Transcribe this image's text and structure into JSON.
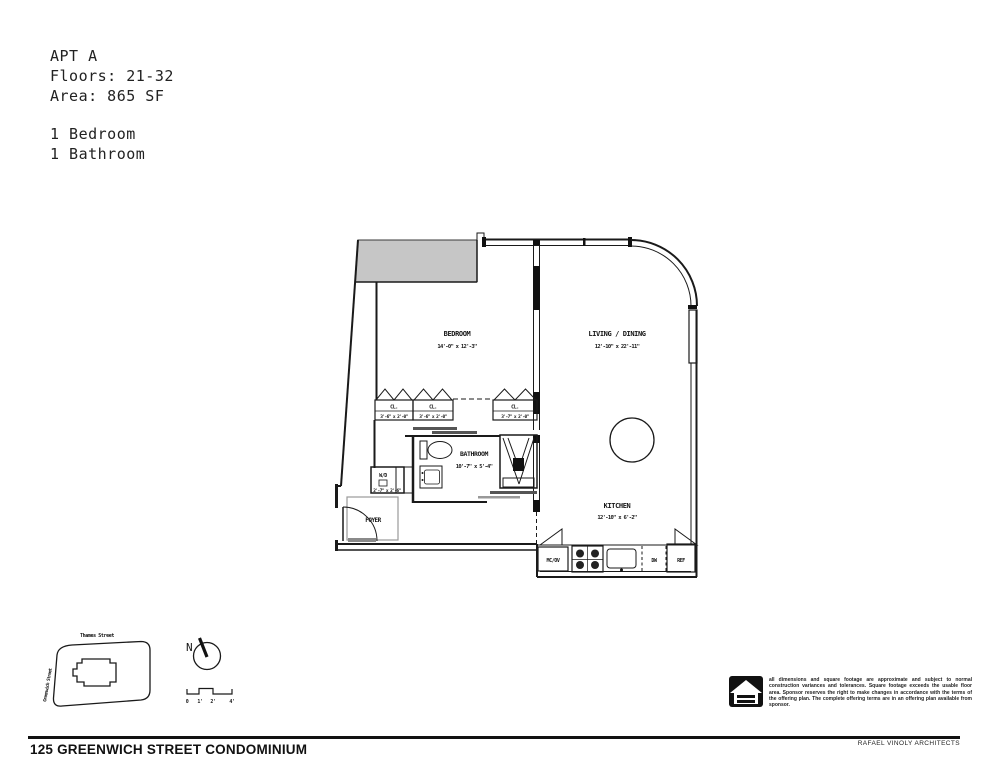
{
  "colors": {
    "line": "#1a1a1a",
    "poche": "#c6c6c6",
    "background": "#ffffff",
    "door_gray": "#8a8a8a"
  },
  "unit_info": {
    "name": "APT A",
    "floors": "Floors: 21-32",
    "area": "Area: 865 SF",
    "bedrooms": "1 Bedroom",
    "bathrooms": "1 Bathroom"
  },
  "plan": {
    "bedroom": {
      "label": "BEDROOM",
      "dims": "14'-0\" x 12'-3\""
    },
    "living_dining": {
      "label": "LIVING / DINING",
      "dims": "12'-10\" x 22'-11\""
    },
    "bathroom": {
      "label": "BATHROOM",
      "dims": "10'-7\" x 5'-4\""
    },
    "kitchen": {
      "label": "KITCHEN",
      "dims": "12'-10\" x 6'-2\""
    },
    "foyer": {
      "label": "FOYER"
    },
    "washer_dryer": {
      "label": "W/D",
      "dims": "2'-7\" x 2'-6\""
    },
    "closets": [
      {
        "label": "CL.",
        "dims": "3'-6\" x 2'-0\""
      },
      {
        "label": "CL.",
        "dims": "3'-6\" x 2'-0\""
      },
      {
        "label": "CL.",
        "dims": "3'-7\" x 2'-0\""
      }
    ],
    "appliances": {
      "microwave_oven": "MC/OV",
      "dishwasher": "DW",
      "refrigerator": "REF"
    }
  },
  "site_map": {
    "street_top": "Thames Street",
    "street_left": "Greenwich Street"
  },
  "compass": {
    "label": "N"
  },
  "scale_bar": {
    "ticks": [
      "0",
      "1'",
      "2'",
      "4'"
    ]
  },
  "disclaimer": "all dimensions and square footage are approximate and subject to normal construction variances and tolerances. Square footage exceeds the usable floor area. Sponsor reserves the right to make changes in accordance with the terms of the offering plan. The complete offering terms are in an offering plan available from sponsor.",
  "footer": {
    "building": "125 GREENWICH STREET CONDOMINIUM",
    "architect": "RAFAEL VINOLY ARCHITECTS"
  }
}
